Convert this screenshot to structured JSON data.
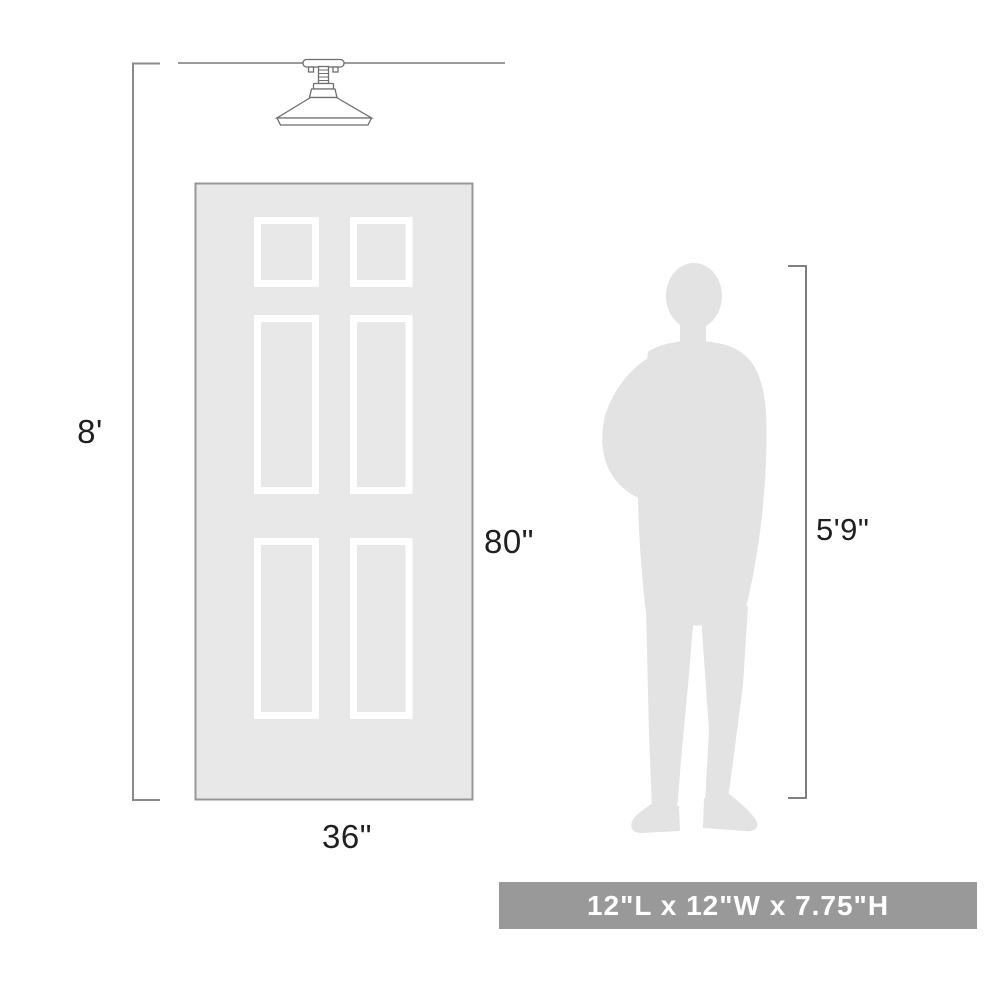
{
  "diagram": {
    "title": "semi-flush ceiling light size comparison diagram",
    "labels": {
      "ceiling_height": "8'",
      "door_height": "80\"",
      "door_width": "36\"",
      "person_height": "5'9\""
    },
    "banner": {
      "text": "12\"L x 12\"W x 7.75\"H"
    },
    "icons": {
      "fixture": "semi-flush-mount-ceiling-light",
      "door": "six-panel-door",
      "person": "man-silhouette"
    },
    "colors": {
      "background": "#ffffff",
      "door_fill": "#e8e8e8",
      "door_border": "#979797",
      "panel_stroke": "#ffffff",
      "silhouette": "#e3e3e3",
      "dimension_line": "#8a8a8a",
      "fixture_line": "#6e6e6e",
      "label_text": "#1f1f1f",
      "banner_bg": "#999999",
      "banner_text": "#ffffff"
    }
  }
}
